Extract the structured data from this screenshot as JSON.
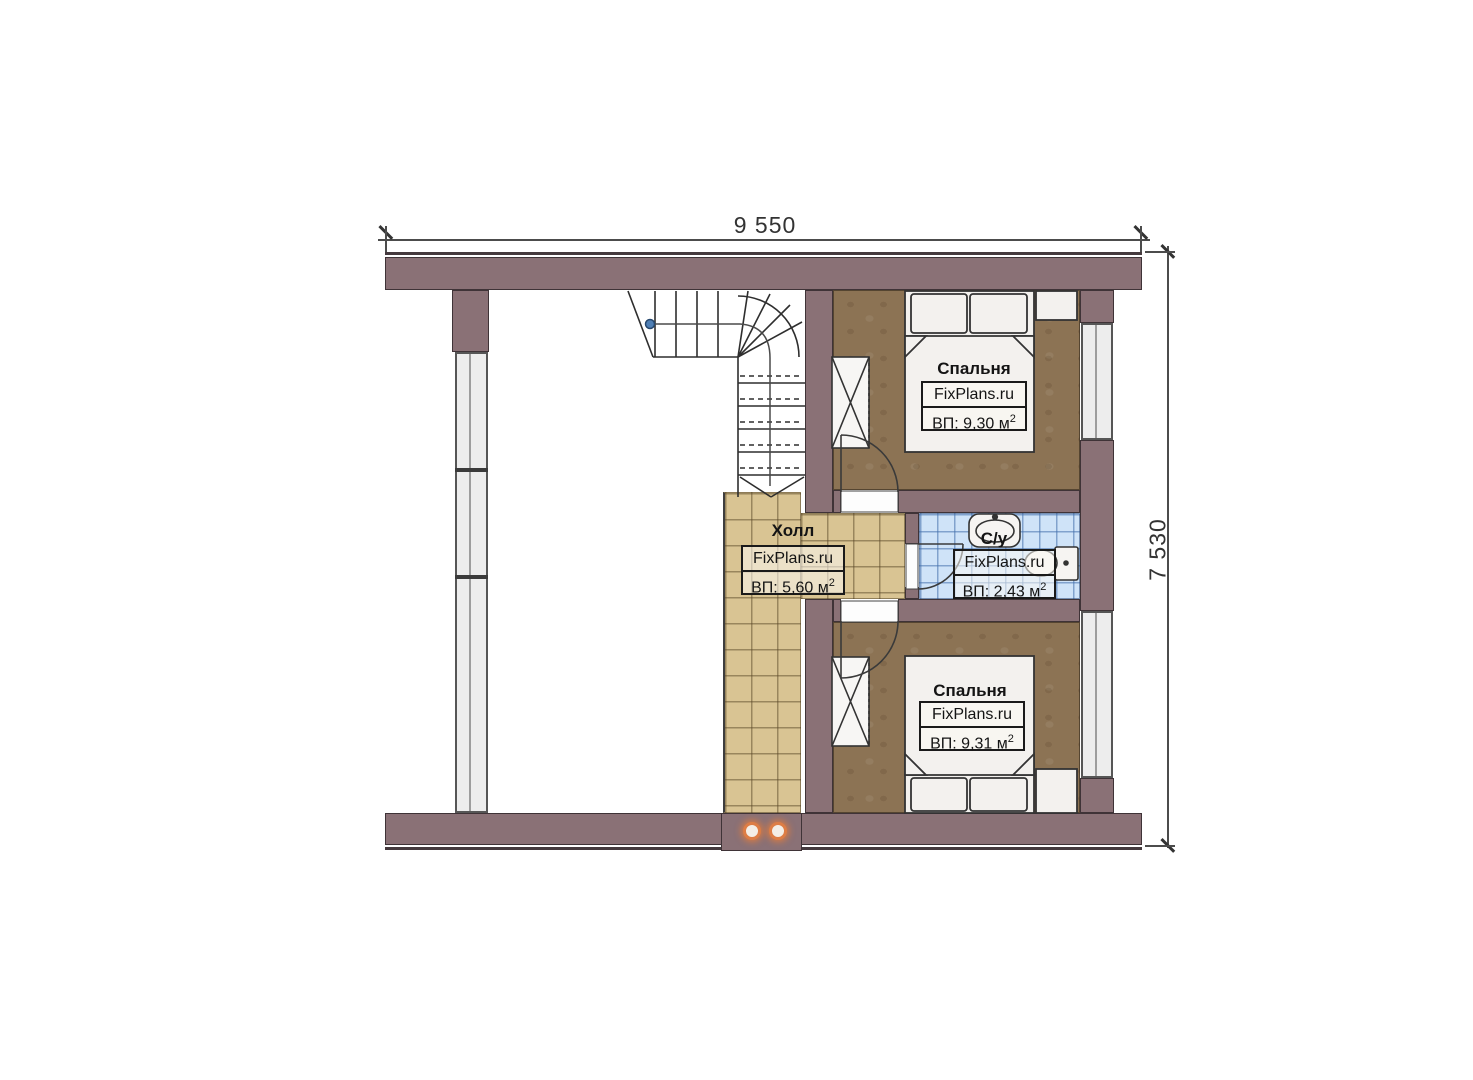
{
  "plan": {
    "type": "floor-plan",
    "dimension_top": "9 550",
    "dimension_right": "7 530"
  },
  "rooms": {
    "bedroom_upper": {
      "name": "Спальня",
      "watermark": "FixPlans.ru",
      "area": "ВП: 9,30 м",
      "area_sup": "2"
    },
    "bedroom_lower": {
      "name": "Спальня",
      "watermark": "FixPlans.ru",
      "area": "ВП: 9,31 м",
      "area_sup": "2"
    },
    "hall": {
      "name": "Холл",
      "watermark": "FixPlans.ru",
      "area": "ВП: 5,60 м",
      "area_sup": "2"
    },
    "bathroom": {
      "name": "С/у",
      "watermark": "FixPlans.ru",
      "area": "ВП: 2,43 м",
      "area_sup": "2"
    }
  },
  "colors": {
    "wall": "#8a7176",
    "wall_edge": "#453a3e",
    "bedroom_floor": "#8c7354",
    "hall_tile": "#d9c493",
    "bathroom_tile": "#cfe3f8",
    "window_glass": "#ededed",
    "accent_dot": "#dd7d45",
    "walkline_dot": "#4f7fb5"
  }
}
